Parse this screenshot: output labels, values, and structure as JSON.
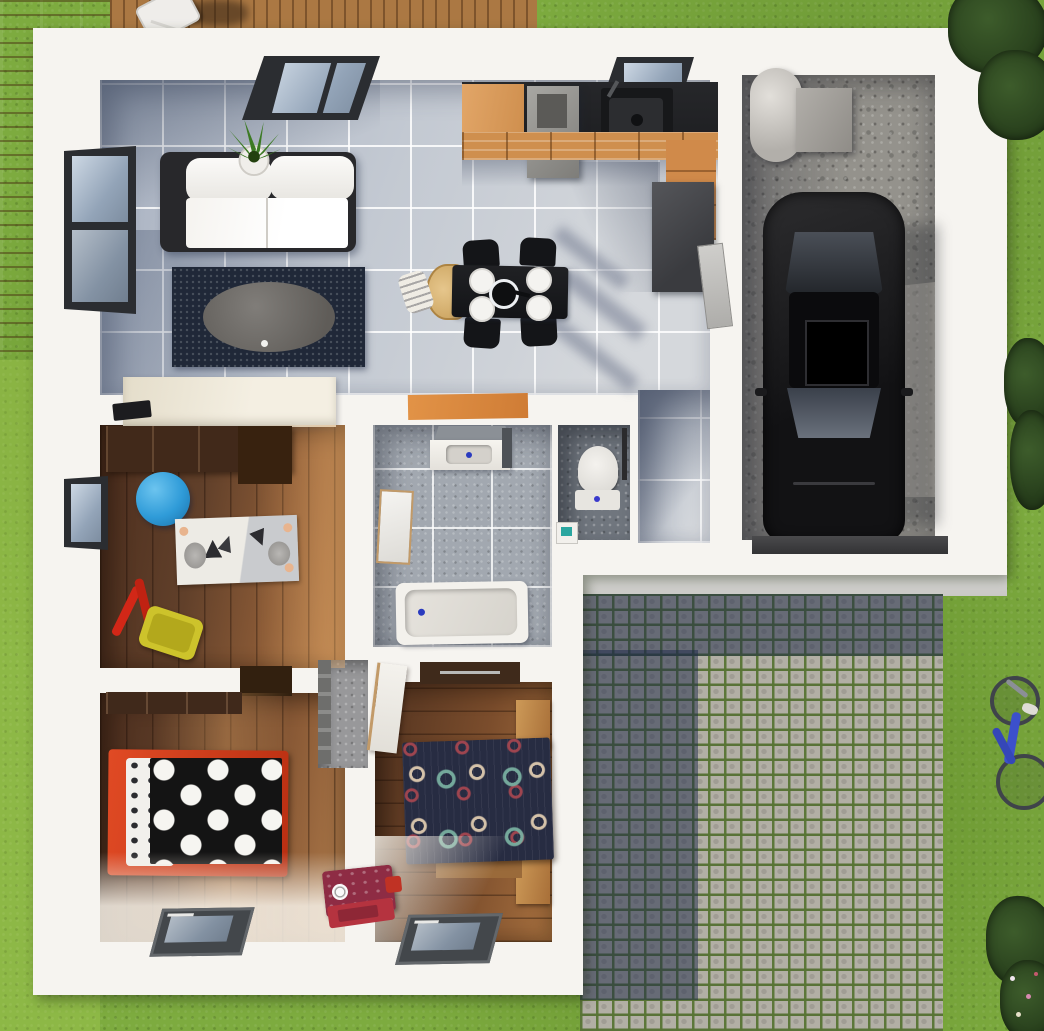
{
  "scene": {
    "title": "Top-down 3D floor plan render of a single-storey house",
    "view": "bird's-eye / plan view",
    "environment": [
      "lawn",
      "wooden deck with lounge chair",
      "cobblestone driveway with grass joints",
      "shrubs and flower bed",
      "blue bicycle lying on the lawn"
    ]
  },
  "palette": {
    "grass": "#7dab3f",
    "deck_wood": "#ab7843",
    "wall_white": "#f6f4f0",
    "tile_floor": "#c3c9d2",
    "bath_tile": "#a2a8b0",
    "wood_floor": "#8a5a36",
    "concrete": "#94928c",
    "cobblestone": "#b2afa5",
    "shadow_blue": "#1c2848",
    "accent_orange": "#d98a46",
    "kitchen_counter": "#222326",
    "bed1_frame_red": "#cf3a1d",
    "ball_blue": "#2f9bd8",
    "bike_blue": "#3c50cc"
  },
  "rooms": [
    {
      "id": "living-room",
      "name": "Living room",
      "floor": "light grey tile",
      "items": [
        "white two-seat sofa with black frame",
        "navy rug",
        "grey oval coffee table",
        "potted plant",
        "cream TV sideboard",
        "black TV"
      ]
    },
    {
      "id": "kitchen",
      "name": "Open kitchen / dining",
      "floor": "light grey tile",
      "items": [
        "black countertop with sink and extractor block",
        "orange-front cabinets",
        "dark tall unit",
        "black dining table",
        "4 black chairs",
        "wooden high chair",
        "4 white plates",
        "black pot",
        "orange doormat"
      ]
    },
    {
      "id": "entry-hall",
      "name": "Entry hall",
      "floor": "light grey tile",
      "items": [
        "front door",
        "door to garage"
      ]
    },
    {
      "id": "garage",
      "name": "Garage",
      "floor": "concrete",
      "items": [
        "black car",
        "grey boiler cylinder",
        "grey storage box",
        "garage door"
      ]
    },
    {
      "id": "kids-room",
      "name": "Kids room / office",
      "floor": "walnut plank",
      "items": [
        "dark wardrobe-desk",
        "blue gym ball",
        "animal-print rug",
        "red toy tools",
        "yellow toy bin",
        "window"
      ]
    },
    {
      "id": "bathroom",
      "name": "Bathroom",
      "floor": "grey speckled tile",
      "items": [
        "vanity basin",
        "leaning mirror",
        "bathtub"
      ]
    },
    {
      "id": "wc",
      "name": "WC",
      "floor": "dark grey tile",
      "items": [
        "toilet",
        "small hand basin"
      ]
    },
    {
      "id": "bedroom-1",
      "name": "Bedroom 1",
      "floor": "walnut plank",
      "items": [
        "red-frame bed with black white-dot duvet",
        "patterned pillows",
        "dark wardrobe",
        "low window"
      ]
    },
    {
      "id": "bedroom-2",
      "name": "Bedroom 2",
      "floor": "walnut plank",
      "items": [
        "double bed with navy circle-pattern duvet",
        "wood headboard blocks",
        "wardrobe",
        "closet nook",
        "maroon toy oven with red tray",
        "low window"
      ]
    }
  ]
}
